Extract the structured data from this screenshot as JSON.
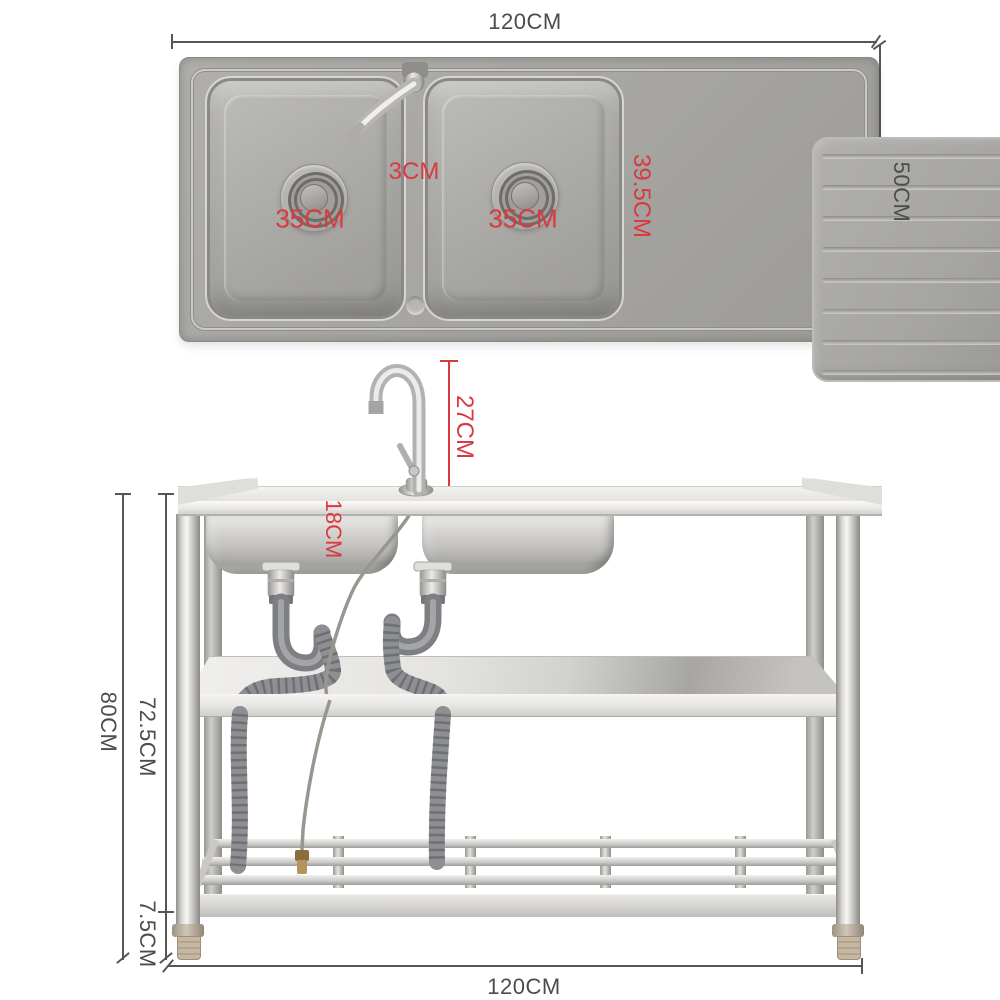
{
  "colors": {
    "dimension_red": "#d93a40",
    "dimension_dark": "#4c4c4c",
    "steel_gray": "#a7a6a2",
    "pipe_gray": "#7d7f83",
    "foot_beige": "#c6b7a2"
  },
  "top_view": {
    "overall_width_label": "120CM",
    "overall_depth_label": "50CM",
    "left_bowl_width_label": "35CM",
    "right_bowl_width_label": "35CM",
    "bowl_gap_label": "3CM",
    "bowl_length_label": "39.5CM"
  },
  "front_view": {
    "faucet_height_label": "27CM",
    "bowl_depth_label": "18CM",
    "overall_height_label": "80CM",
    "frame_height_label": "72.5CM",
    "foot_height_label": "7.5CM",
    "overall_width_label": "120CM"
  }
}
